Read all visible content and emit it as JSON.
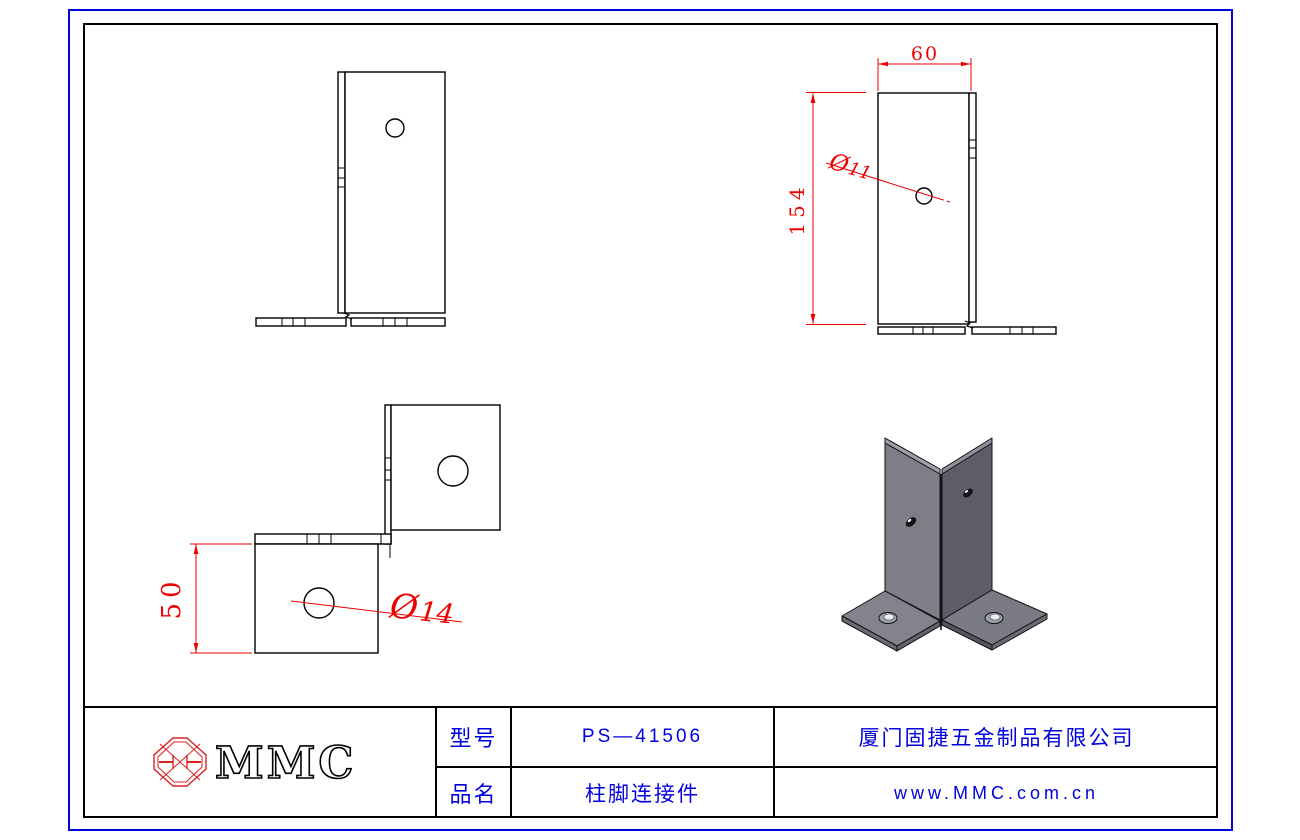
{
  "colors": {
    "frame_blue": "#0000e0",
    "title_text_blue": "#0000e0",
    "dimension_red": "#ee0000",
    "line_black": "#000000",
    "logo_red": "#dd2222",
    "iso_left_plate": "#7e7e87",
    "iso_right_plate": "#5d5d69",
    "iso_base_top": "#83838d",
    "iso_edge_dark": "#62626c",
    "iso_top_band": "#a0a0aa"
  },
  "dimensions": {
    "top_width": "60",
    "side_height": "154",
    "side_hole_prefix": "Ø",
    "side_hole_value": "11",
    "base_height": "50",
    "base_hole_prefix": "Ø",
    "base_hole_value": "14"
  },
  "title_block": {
    "logo_text": "MMC",
    "model_label": "型号",
    "model_value": "PS—41506",
    "product_label": "品名",
    "product_value": "柱脚连接件",
    "company_name": "厦门固捷五金制品有限公司",
    "website": "www.MMC.com.cn"
  }
}
